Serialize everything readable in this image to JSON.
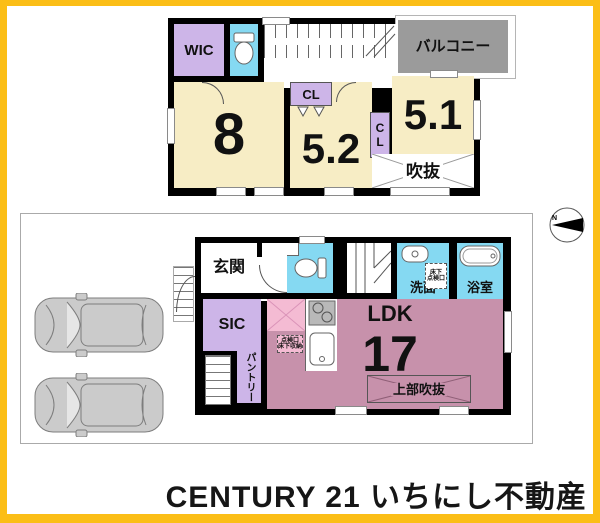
{
  "meta": {
    "type": "floor-plan",
    "frame_color": "#FBBE17",
    "canvas_color": "#FFFFFF"
  },
  "colors": {
    "wall": "#000000",
    "room_cream": "#F7EDC5",
    "closet_lavender": "#CDB5E8",
    "water_cyan": "#85D9F2",
    "ldk_pink": "#C791AB",
    "kitchen_light_pink": "#F4BBD3",
    "balcony_gray": "#9B9B9B",
    "car_gray": "#CBCBCB"
  },
  "floor2": {
    "wic_label": "WIC",
    "cl_label": "CL",
    "cl_vertical_label": "CL",
    "room8_label": "8",
    "room52_label": "5.2",
    "room51_label": "5.1",
    "balcony_label": "バルコニー",
    "void_label": "吹抜"
  },
  "floor1": {
    "entrance_label": "玄関",
    "sic_label": "SIC",
    "pantry_label": "パントリー",
    "ldk_label": "LDK",
    "ldk_size": "17",
    "upper_void_label": "上部吹抜",
    "washroom_label": "洗面",
    "bathroom_label": "浴室",
    "wash_hatch_line1": "床下",
    "wash_hatch_line2": "点検口",
    "kitchen_hatch_line1": "点検口",
    "kitchen_hatch_line2": "床下収納"
  },
  "compass": {
    "north_label": "N"
  },
  "footer": {
    "brand": "CENTURY 21 いちにし不動産"
  }
}
